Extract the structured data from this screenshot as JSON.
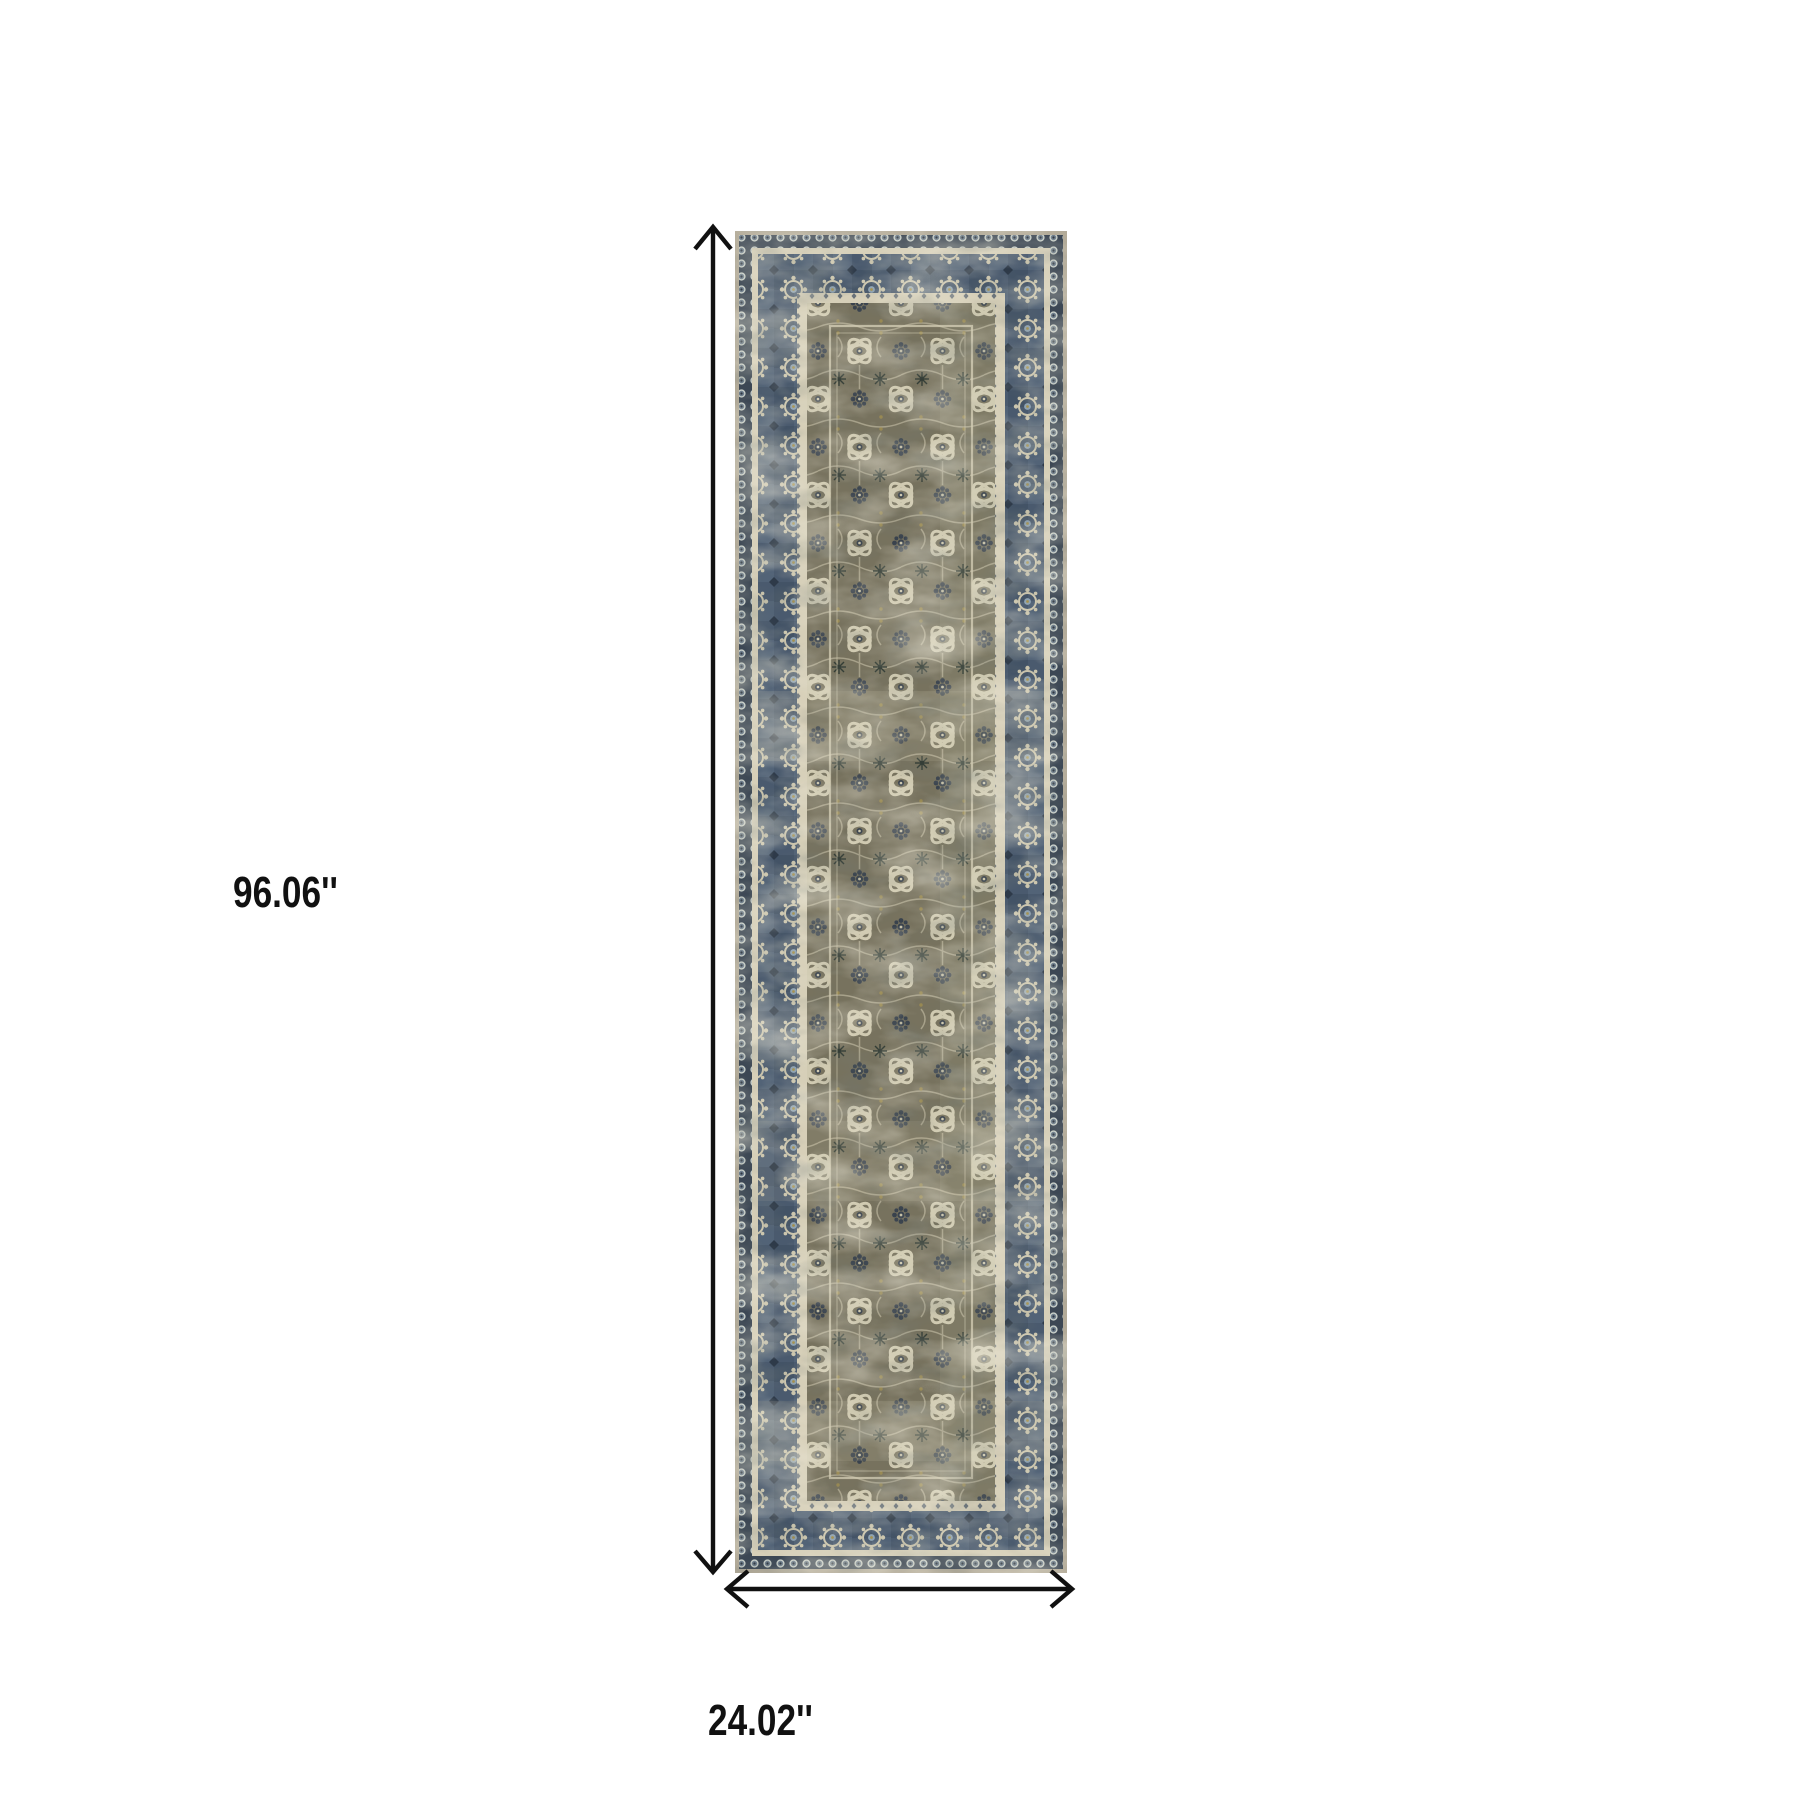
{
  "diagram": {
    "type": "product-dimension-diagram",
    "background": "#ffffff",
    "height_label": "96.06''",
    "width_label": "24.02''",
    "arrow_color": "#111111"
  },
  "rug": {
    "name": "distressed-oriental-runner-rug",
    "description": "Vertical vintage-style runner rug, olive-taupe distressed floral field with navy-blue ornamental borders and cream guard stripes",
    "colors": {
      "outer_edge_tan": "#b3ab99",
      "dots_band_navy": "#3c4754",
      "border_navy": "#4a5a6e",
      "border_navy_dark": "#2e3a49",
      "border_blue_light": "#8fa3b2",
      "guard_cream": "#d6cfb8",
      "field_olive": "#77725e",
      "motif_cream": "#cfc9b0",
      "motif_navy": "#39424d",
      "accent_gold": "#a3904f"
    }
  }
}
